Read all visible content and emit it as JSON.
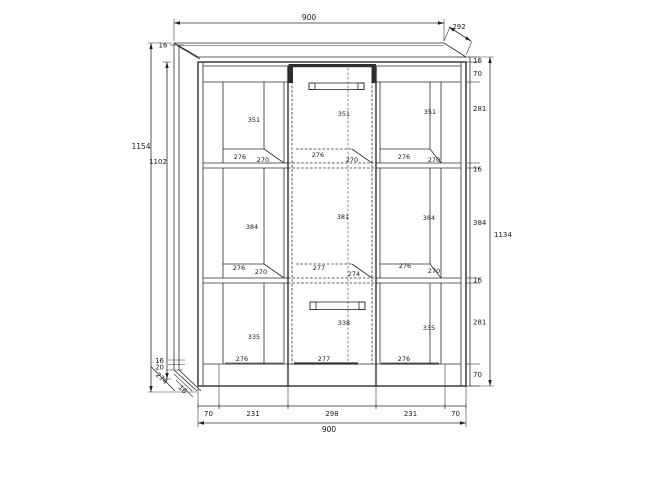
{
  "drawing": {
    "kind": "cabinet-technical-drawing",
    "dims": {
      "top_width": "900",
      "top_depth": "292",
      "top_thickness": "16",
      "height_total": "1154",
      "height_inner": "1102",
      "height_front": "1134",
      "right_chain": [
        "16",
        "70",
        "281",
        "16",
        "384",
        "16",
        "281",
        "70"
      ],
      "bottom_chain": [
        "70",
        "231",
        "298",
        "231",
        "70"
      ],
      "bottom_width": "900",
      "base_panel": "16",
      "base_plinth": "20",
      "base_depth": "274",
      "base_edge": "16"
    },
    "compartments": {
      "row1": [
        {
          "height": "351",
          "width": "276",
          "depth": "270"
        },
        {
          "height": "351",
          "width": "276",
          "depth": "270"
        },
        {
          "height": "351",
          "width": "276",
          "depth": "270"
        }
      ],
      "row2": [
        {
          "height": "384",
          "width": "276",
          "depth": "270"
        },
        {
          "height": "381",
          "width": "277",
          "depth": "274"
        },
        {
          "height": "384",
          "width": "276",
          "depth": "270"
        }
      ],
      "row3": [
        {
          "height": "335",
          "width": "276"
        },
        {
          "height": "338",
          "width": "277"
        },
        {
          "height": "335",
          "width": "276"
        }
      ]
    }
  }
}
